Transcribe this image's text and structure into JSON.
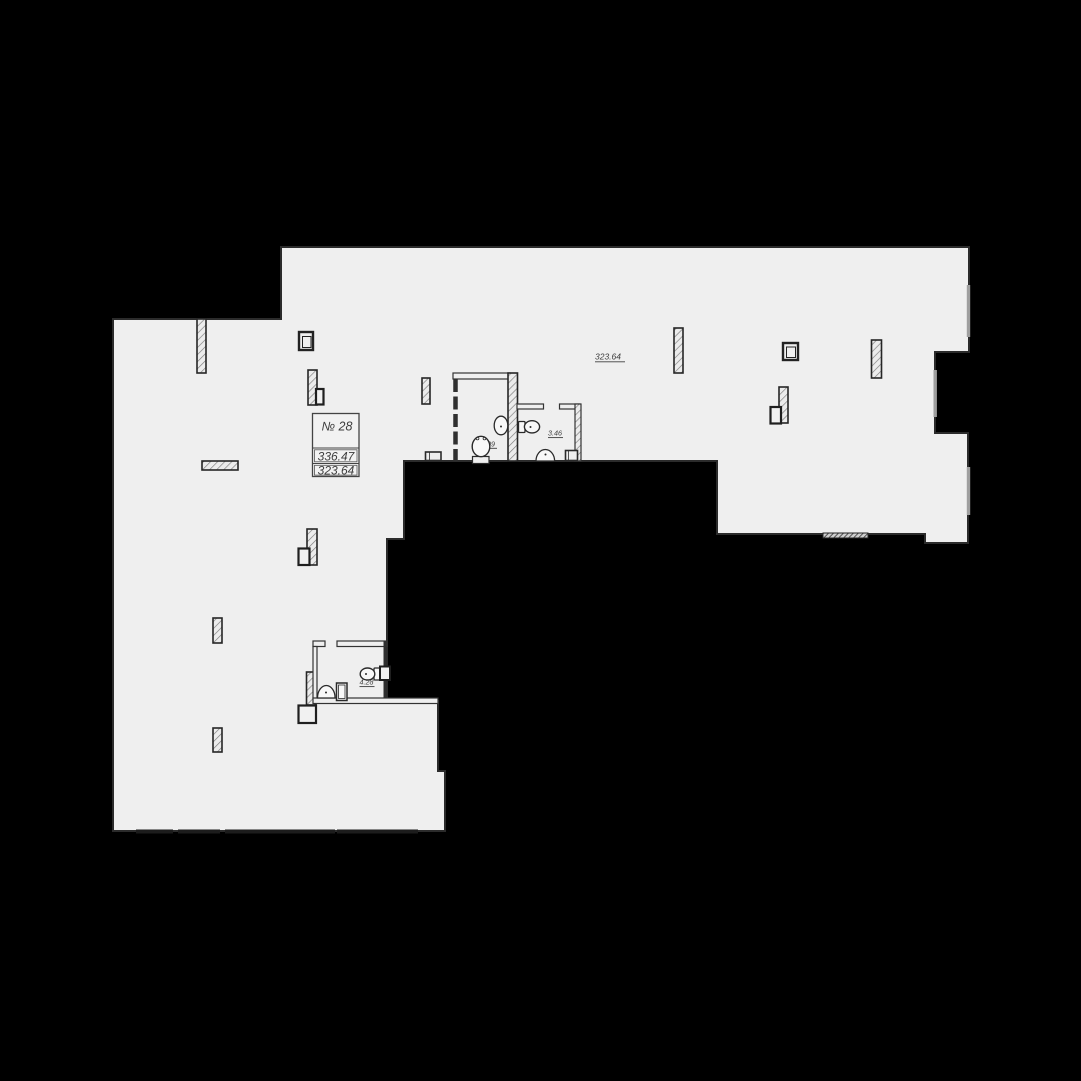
{
  "unit_box": {
    "unit_number": "№ 28",
    "area_top": "336.47",
    "area_bottom": "323.64"
  },
  "floor_note": "323.64",
  "rooms": [
    {
      "name": "wc-1",
      "area": "3.09"
    },
    {
      "name": "wc-2",
      "area": "3.46"
    },
    {
      "name": "wc-3",
      "area": "4.28"
    }
  ],
  "colors": {
    "background": "#000000",
    "floor": "#efefef",
    "outline": "#2b2b2b",
    "wall": "#2f2f2f",
    "window": "#9e9e9e",
    "text": "#3d3d3d"
  }
}
